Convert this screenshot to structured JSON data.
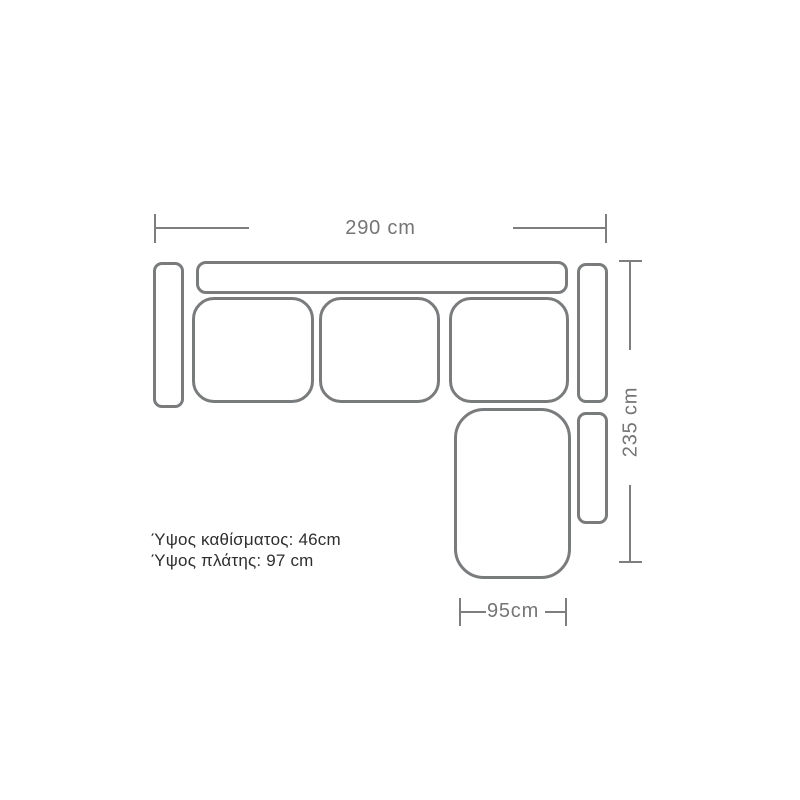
{
  "diagram": {
    "type": "corner-sofa-top-view-dimension-drawing",
    "dimensions": {
      "top_width": "290 cm",
      "right_depth": "235 cm",
      "bottom_chaise_width": "95cm"
    },
    "notes": {
      "seat_height": "Ύψος καθίσματος: 46cm",
      "back_height": "Ύψος πλάτης: 97 cm"
    },
    "measurements": {
      "width_cm": 290,
      "depth_cm": 235,
      "chaise_width_cm": 95,
      "seat_height_cm": 46,
      "back_height_cm": 97
    },
    "parts": [
      "left-armrest",
      "backrest",
      "seat-cushion-1",
      "seat-cushion-2",
      "seat-cushion-3",
      "right-backrest",
      "chaise-seat",
      "chaise-armrest"
    ],
    "colors": {
      "background": "#ffffff",
      "outline": "#797b7d",
      "dimension_line": "#7e7e7e",
      "dimension_text": "#757575",
      "note_text": "#2e2e2e"
    }
  }
}
